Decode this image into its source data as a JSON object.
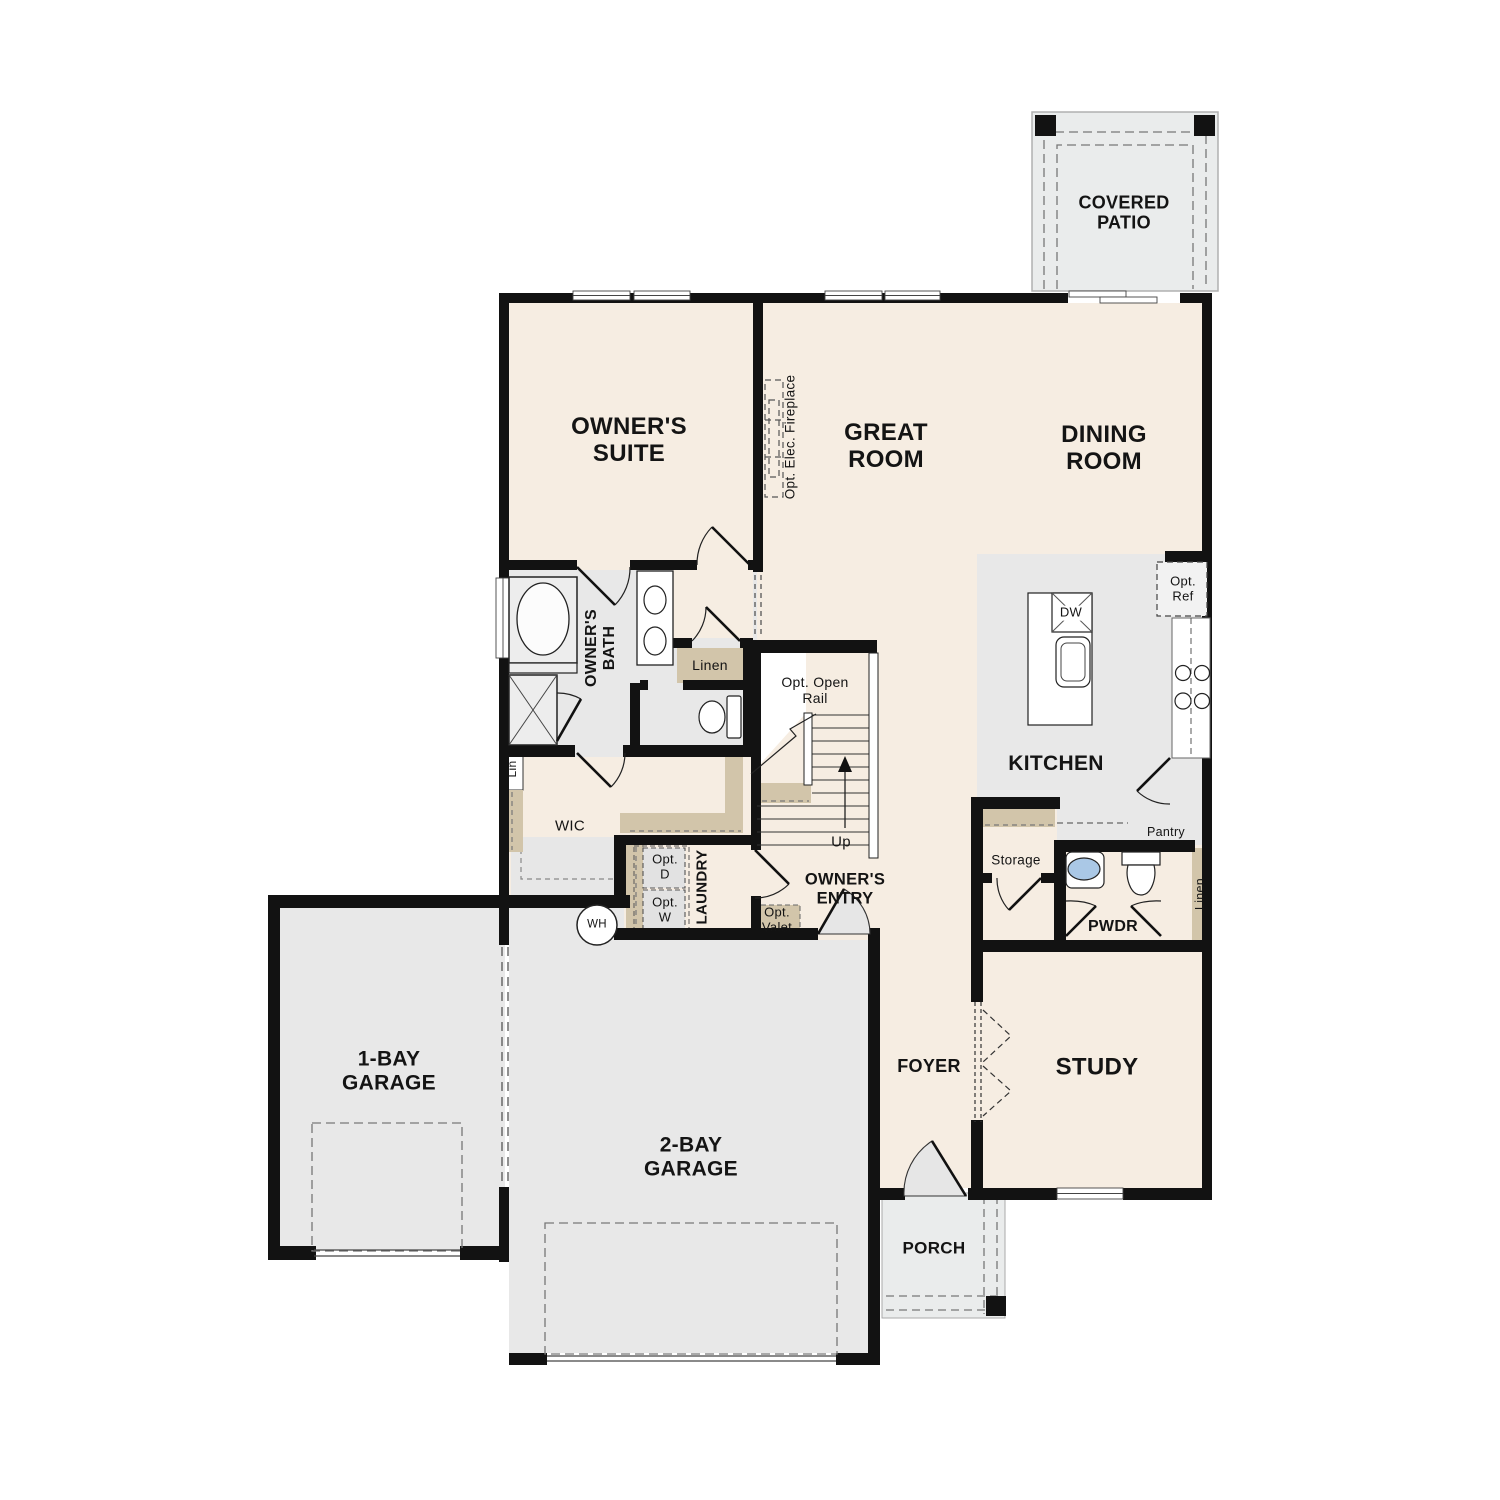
{
  "page": {
    "title": "Single-story home floor plan",
    "type": "floor-plan-diagram"
  },
  "colors": {
    "floor_beige": "#f6ede2",
    "floor_gray": "#e8e8e8",
    "outdoor_gray": "#eaecec",
    "shelf_tan": "#d2c5aa",
    "wall_black": "#121212",
    "sink_blue": "#aac8e6",
    "dash_gray": "#777777"
  },
  "labels": {
    "covered_patio": "COVERED\nPATIO",
    "owners_suite": "OWNER'S\nSUITE",
    "great_room": "GREAT\nROOM",
    "dining_room": "DINING\nROOM",
    "opt_fireplace": "Opt. Elec. Fireplace",
    "owners_bath": "OWNER'S\nBATH",
    "linen_bath": "Linen",
    "lin": "Lin",
    "wic": "WIC",
    "opt_open_rail": "Opt. Open\nRail",
    "up": "Up",
    "owners_entry": "OWNER'S\nENTRY",
    "opt_valet": "Opt.\nValet",
    "opt_d": "Opt.\nD",
    "opt_w": "Opt.\nW",
    "laundry": "LAUNDRY",
    "wh": "WH",
    "kitchen": "KITCHEN",
    "dw": "DW",
    "opt_ref": "Opt.\nRef",
    "pantry": "Pantry",
    "storage": "Storage",
    "pwdr": "PWDR",
    "linen_hall": "Linen",
    "foyer": "FOYER",
    "study": "STUDY",
    "porch": "PORCH",
    "garage_1bay": "1-BAY\nGARAGE",
    "garage_2bay": "2-BAY\nGARAGE"
  }
}
